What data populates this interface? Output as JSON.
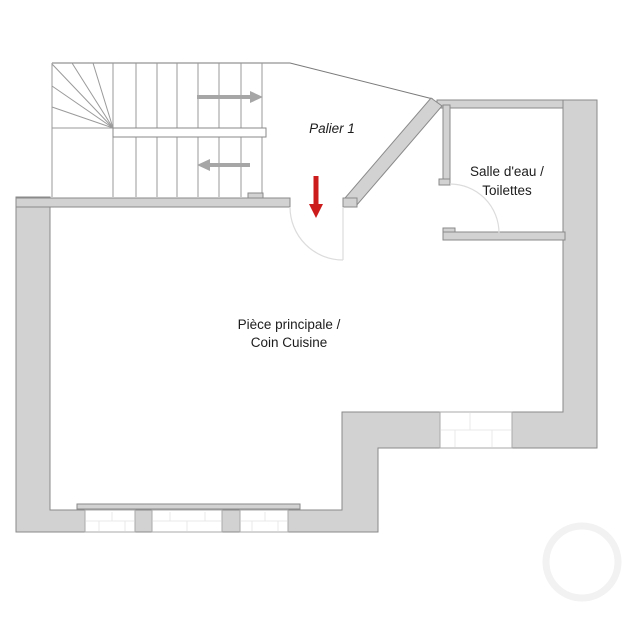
{
  "title": "Floor plan - first floor",
  "labels": {
    "landing": "Palier 1",
    "bathroom_line1": "Salle d'eau /",
    "bathroom_line2": "Toilettes",
    "main_room_line1": "Pièce principale /",
    "main_room_line2": "Coin Cuisine"
  },
  "icons": {
    "stair_up_arrow": "right-arrow",
    "stair_down_arrow": "left-arrow",
    "entry_arrow": "down-arrow-red"
  },
  "colors": {
    "wall_fill": "#d2d2d2",
    "wall_stroke": "#8a8a8a",
    "stair_line": "#9a9a9a",
    "direction_arrow": "#a6a6a6",
    "entry_arrow": "#cc1c1c",
    "door_arc": "#dcdcdc",
    "window_joint": "#e9e9e9",
    "boundary_line": "#7a7a7a",
    "text": "#1c1c1c",
    "ghost_mark": "#f2f2f2"
  }
}
